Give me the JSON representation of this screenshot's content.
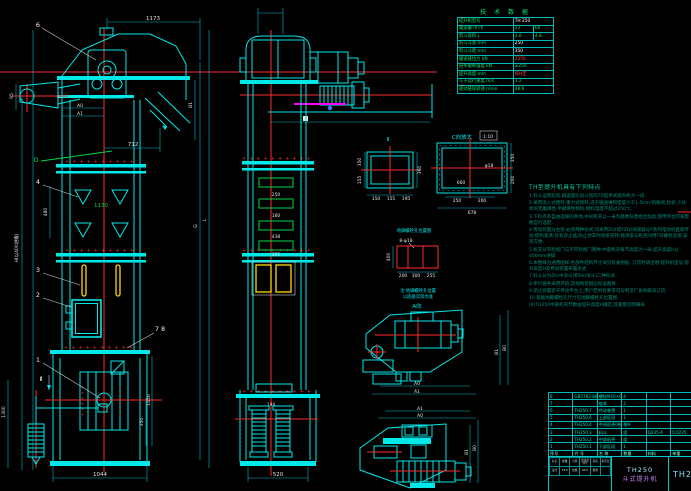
{
  "tech_table": {
    "title": "技 术 数 据",
    "rows": [
      [
        "提升机型号",
        "^TH 250"
      ],
      [
        "输送量 m³/h",
        "23",
        "60"
      ],
      [
        "料斗容积 L",
        "3.0",
        "4.8"
      ],
      [
        "料斗斗宽 mm",
        "^250"
      ],
      [
        "料斗斗距 mm",
        "^350"
      ],
      [
        "输送链拉力 kN",
        "*2350"
      ],
      [
        "链条破断强度 kN",
        "≥250"
      ],
      [
        "提升高度 mm",
        "*按H定"
      ],
      [
        "斗子运行速度 m/s",
        "1.2"
      ],
      [
        "驱动链轮转速 r/min",
        "48.6"
      ]
    ]
  },
  "features": {
    "title": "TH型提升机具有下列特点",
    "lines": [
      "1.料斗运距较宽,输送量比同斗宽的TD型带式提升机大一倍.",
      "2.采用流入式喂料,重力式卸料,适于输送堆积密度小于1.5t/m³的粉状,粒状,小块状的无磨琢性,半磨琢性物料,物料温度不超过250℃.",
      "3.下料点有自由选择的余地,中间机壳以一米为基数任意组合加高,使用单位可按需要自行选配.",
      "4.传动装置分左装,右装两种形式,均采用ZQ(或YZQ)减速器与Y系列电动机直联传动,结构紧凑;装有逆止器,防止停车时链条逆转;轴承座与机壳间用T形螺栓连接,安装方便.",
      "5.机壳分带检视门与不带检视门两种,中部机壳每节高度为一米,提升高度H以400mm进级.",
      "6.本图样为通用图样,各部件结构尺寸详见有关图纸.  订货时请注明:提升机型号,提升高度H及传动装置布置形式.",
      "7.料斗分为Zh(中深斗)和Sh(深斗)二种形式.",
      "8.牵引链条采用环链,其规格见相应标准图样.",
      "9.逆止装置装于传动平台上,用户若另有要求可与制造厂协商解决订货.",
      "10.基础地脚螺栓孔尺寸见地脚螺栓孔位置图.",
      "(9)TH250中部机壳节数由提升高度H确定,其重量见明细表."
    ]
  },
  "bom": {
    "rows": [
      [
        "8",
        "GB5782-86",
        "螺栓M16×60",
        "4",
        "",
        "",
        "*按H定"
      ],
      [
        "7",
        "",
        "链条",
        "2",
        "",
        "",
        "*L=按H"
      ],
      [
        "6",
        "TH250.7",
        "传动装置",
        "1",
        "",
        "",
        ""
      ],
      [
        "5",
        "TH250.6",
        "上部区段",
        "1",
        "",
        "",
        ""
      ],
      [
        "4",
        "TH250.4",
        "中间机壳(带门)",
        "*按H",
        "",
        "",
        ""
      ],
      [
        "3",
        "TH250.3",
        "料斗",
        "*组",
        "Q235-A",
        "0.0235",
        "*200"
      ],
      [
        "2",
        "TH250.2",
        "中部机壳",
        "*组",
        "",
        "",
        "备件"
      ],
      [
        "1",
        "TH250.1",
        "下部区段",
        "1",
        "",
        "",
        "备件"
      ],
      [
        "序号",
        "代 号",
        "名  称",
        "数量",
        "材料",
        "单重",
        "备注"
      ]
    ]
  },
  "title_block": {
    "model": "TH250",
    "product": "斗式提升机",
    "drawing_no": "TH250",
    "rev_rows": [
      [
        "标记",
        "处数",
        "分区",
        "更改文件号",
        "签名",
        "年月日"
      ],
      [
        "设计",
        "*03.6",
        "校核",
        "*03.6",
        "批准",
        ""
      ]
    ]
  },
  "dims": {
    "w1173": "1173",
    "w712": "712",
    "a0": "A0",
    "a1": "A1",
    "b0": "B0",
    "b1": "B1",
    "v95": "95",
    "v480": "480",
    "g1130": "1130",
    "w1044": "1044",
    "v1450": "1450",
    "v350": "350",
    "v1300": "1300",
    "hnote": "H(以400进级)",
    "g": "G",
    "l": "L",
    "m250": "250",
    "m160": "160",
    "m438": "438",
    "m355": "355",
    "m144": "144",
    "m520": "520",
    "v2_label": "Ⅱ",
    "v2_b1": "150",
    "v2_b2": "155",
    "v2_b3": "195",
    "v2_r": "360",
    "v2_l1": "350",
    "v2_l2": "155",
    "c_label": "C向放大",
    "c_scale": "1:10",
    "c_660": "660",
    "c_b1": "250",
    "c_b2": "200",
    "c_678": "678",
    "c_r1": "350",
    "c_r2": "200",
    "c_hole": "φ18",
    "a_title": "地脚螺栓孔位置图",
    "a_bolt": "8-φ18",
    "a_b1": "200",
    "a_b2": "300",
    "a_b3": "255",
    "a_left": "400",
    "a_n1": "注:地脚螺栓孔位置",
    "a_n2": "以底座实际为准",
    "a_view": "A向",
    "bolt_row": "++++++++++",
    "bolt_col": "++++++"
  },
  "callouts": {
    "n1": "1",
    "n2": "2",
    "n3": "3",
    "n4": "4",
    "n6": "6",
    "n78": "7  8",
    "d": "D",
    "sec2": "Ⅱ"
  }
}
